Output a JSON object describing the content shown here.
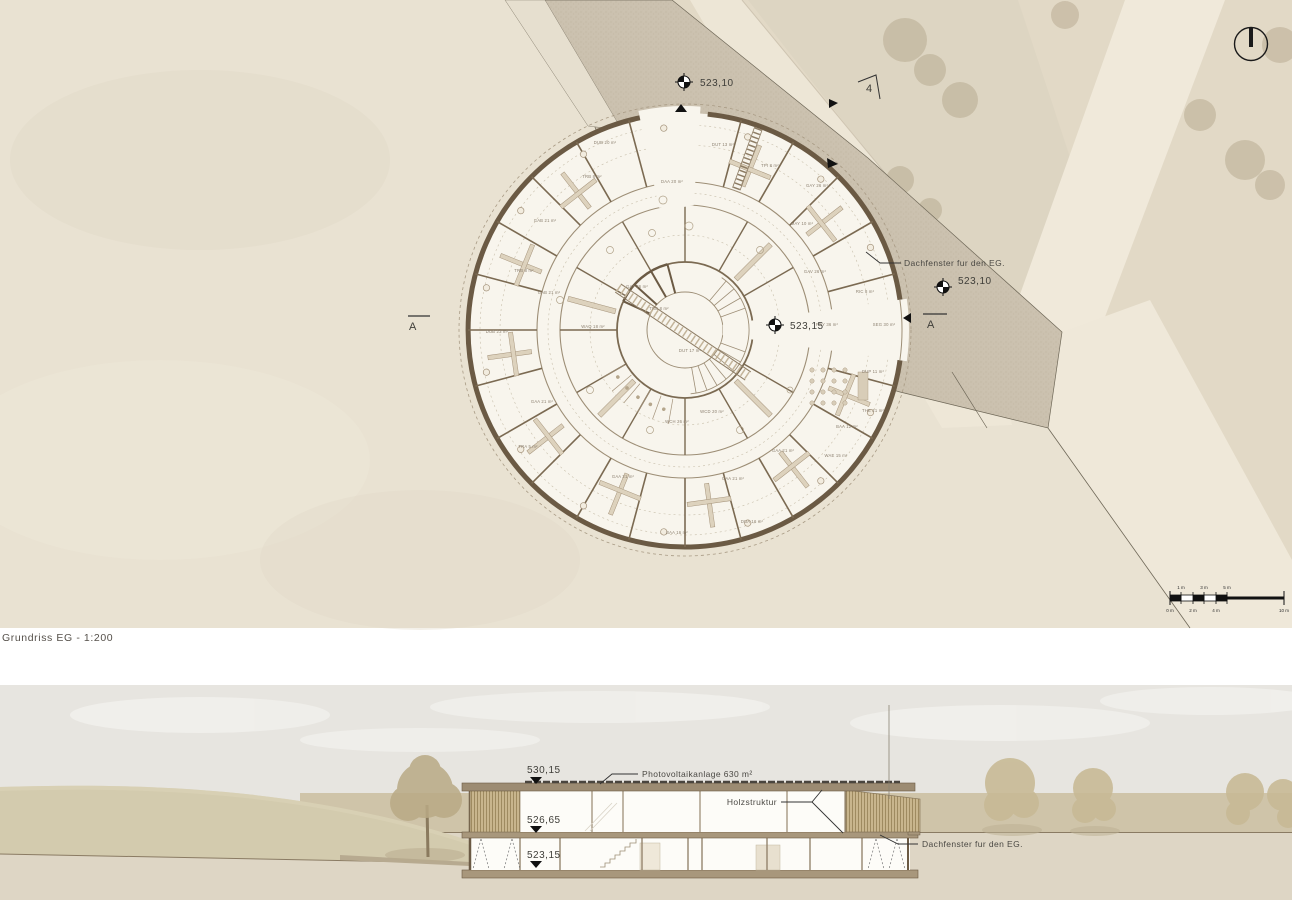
{
  "sheet": {
    "caption": "Grundriss EG - 1:200"
  },
  "plan": {
    "annotations": {
      "spot_top": "523,10",
      "spot_plaza": "523,10",
      "spot_court": "523,15",
      "section_left": "A",
      "section_right": "A",
      "detail_marker": "4",
      "roof_note": "Dachfenster fur den EG."
    },
    "scalebar": {
      "top": [
        "1 m",
        "3 m",
        "5 m"
      ],
      "bottom": [
        "0 m",
        "2 m",
        "4 m",
        "10 m"
      ]
    },
    "rooms": [
      "DUB 23 m²",
      "TRB 8 m²",
      "GAB 21 m²",
      "GAB 21 m²",
      "TRB 8 m²",
      "DUB 20 m²",
      "DAA 20 m²",
      "DUT 13 m²",
      "GAY 26 m²",
      "TPI 8 m²",
      "MAY 10 m²",
      "GAV 26 m²",
      "RIC 8 m²",
      "SEG 30 m²",
      "FOY 36 m²",
      "DUP 11 m²",
      "THE 21 m²",
      "BAA 12 m²",
      "WAE 15 m²",
      "GAA 21 m²",
      "WCD 20 m²",
      "WCH 26 m²",
      "DUT 17 m²",
      "TRE 8 m²",
      "GAT 26 m²",
      "WAQ 18 m²",
      "GAA 21 m²",
      "GAA 21 m²",
      "GAA 21 m²",
      "DUA 16 m²",
      "BAA 16 m²",
      "TRA 5 m²"
    ]
  },
  "section": {
    "levels": [
      "530,15",
      "526,65",
      "523,15"
    ],
    "pv_note": "Photovoltaikanlage 630 m²",
    "wood_note": "Holzstruktur",
    "roof_note": "Dachfenster fur den EG."
  },
  "colors": {
    "wall_brown": "#6b5a44",
    "plaza_tan": "#cbc1af",
    "site_cream": "#e9e2d2",
    "marker_black": "#1a1a1a"
  }
}
